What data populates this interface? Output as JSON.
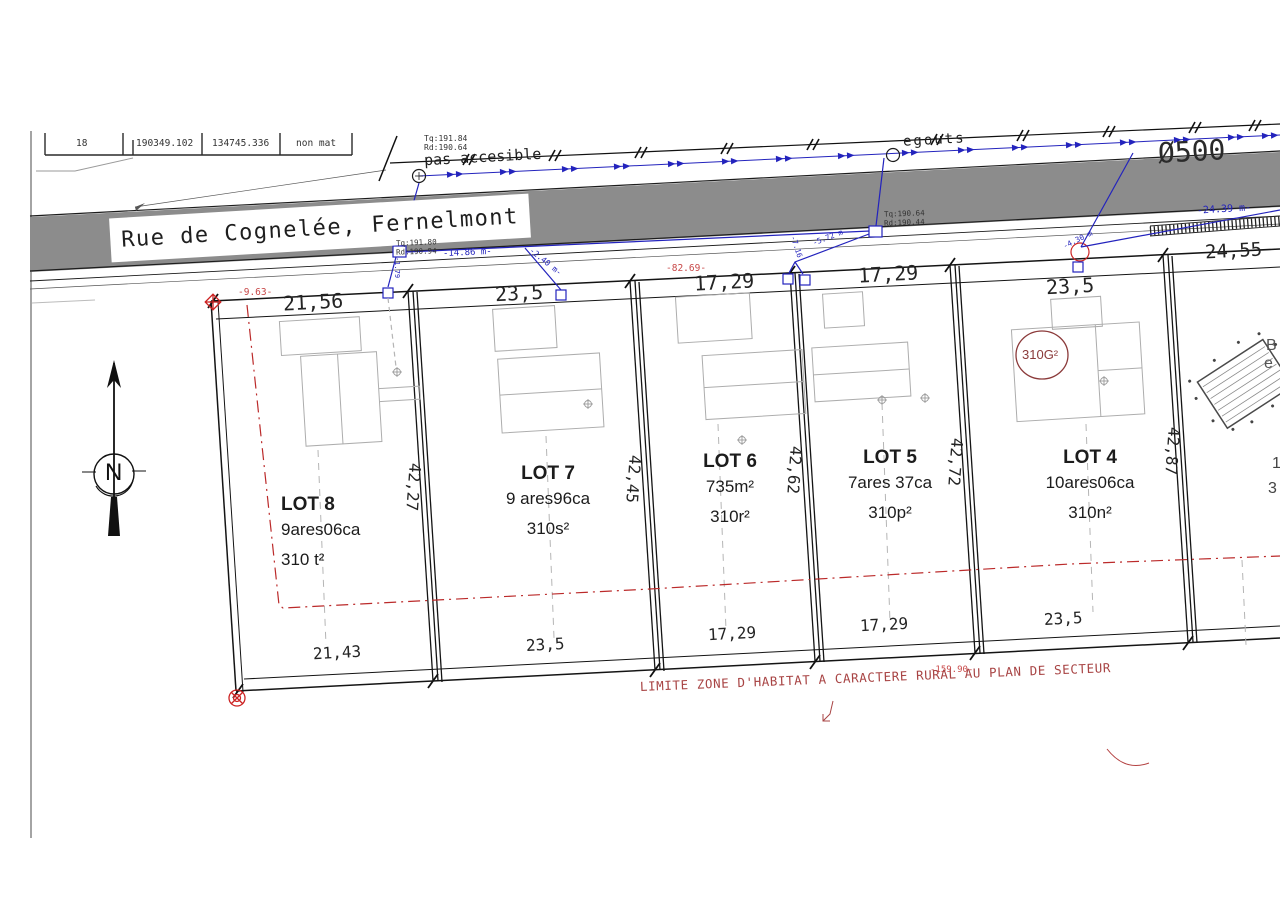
{
  "colors": {
    "road_gray": "#8c8c8c",
    "line_black": "#1c1c1c",
    "utility_blue": "#2323bd",
    "survey_red": "#c23a3a",
    "zone_note_red": "#a84444",
    "parcel_maroon": "#8b3a3a",
    "building_gray": "#adadad"
  },
  "survey_table": {
    "cells": [
      "18",
      "190349.102",
      "134745.336",
      "non mat"
    ]
  },
  "road": {
    "street_label": "Rue de Cognelée, Fernelmont",
    "pas_accesible": "pas accesible",
    "egouts": "egouts",
    "pipe_diameter": "Ø500",
    "tq_left": "Tq:191.84",
    "rd_left": "Rd:190.64",
    "tq_conn": "Tq:191.80",
    "rd_conn": "Rd:190.94",
    "tq_mid": "Tq:190.64",
    "rd_mid": "Rd:190.44"
  },
  "blue_dims": {
    "conn_left_len": "-14.86 m-",
    "conn_left_drop": "-2.40 m-",
    "conn_left_depth": "-1.79",
    "conn_mid_a": "-5.72 m",
    "conn_mid_b": "-7.16",
    "conn_right_drop": "-4.30 m",
    "conn_right_len": "-24.39 m-"
  },
  "red_dims": {
    "left_offset": "-9.63-",
    "street_total": "-82.69-",
    "zone_total": "-159.90-"
  },
  "zone_note": "LIMITE ZONE D'HABITAT A CARACTERE RURAL AU PLAN DE SECTEUR",
  "parcel_circle_label": "310G²",
  "compass_label": "N",
  "dimensions": {
    "top": [
      "21,56",
      "23,5",
      "17,29",
      "17,29",
      "23,5",
      "24,55"
    ],
    "bottom": [
      "21,43",
      "23,5",
      "17,29",
      "17,29",
      "23,5"
    ],
    "sides": [
      "42,27",
      "42,45",
      "42,62",
      "42,72",
      "42,87"
    ]
  },
  "lots": [
    {
      "name": "LOT 8",
      "area": "9ares06ca",
      "parcel": "310 t²"
    },
    {
      "name": "LOT 7",
      "area": "9 ares96ca",
      "parcel": "310s²"
    },
    {
      "name": "LOT 6",
      "area": "735m²",
      "parcel": "310r²"
    },
    {
      "name": "LOT 5",
      "area": "7ares 37ca",
      "parcel": "310p²"
    },
    {
      "name": "LOT 4",
      "area": "10ares06ca",
      "parcel": "310n²"
    }
  ],
  "edge_fragments": {
    "f1": "B",
    "f2": "e",
    "f3": "1",
    "f4": "3"
  }
}
